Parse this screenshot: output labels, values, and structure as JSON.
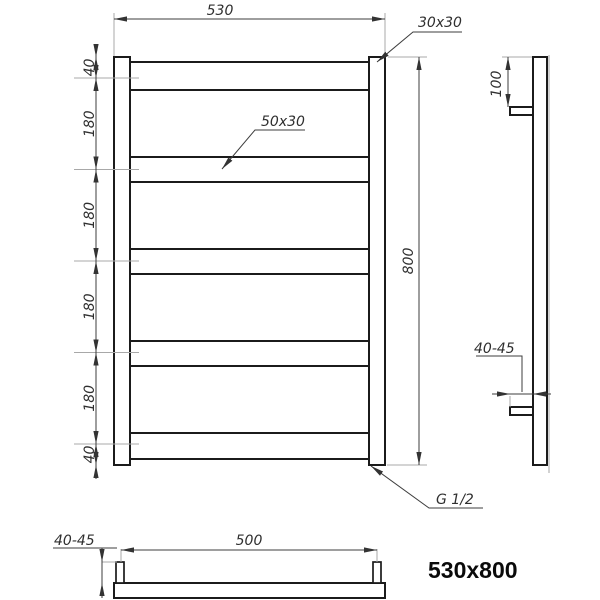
{
  "title_label": "530x800",
  "front_view": {
    "width_dim": "530",
    "height_dim": "800",
    "segments": [
      "40",
      "180",
      "180",
      "180",
      "180",
      "40"
    ],
    "post_profile": "30x30",
    "rail_profile": "50x30",
    "connection_thread": "G 1/2"
  },
  "side_view": {
    "bracket_offset": "100",
    "wall_distance": "40-45"
  },
  "bottom_view": {
    "centers_distance": "500",
    "wall_distance": "40-45"
  },
  "colors": {
    "outline": "#1b1b1b",
    "dimension_line": "#3d3d3d",
    "extension_line": "#a8a8a8",
    "text": "#2f2f2f",
    "title": "#0a0a0a",
    "background": "#ffffff"
  }
}
